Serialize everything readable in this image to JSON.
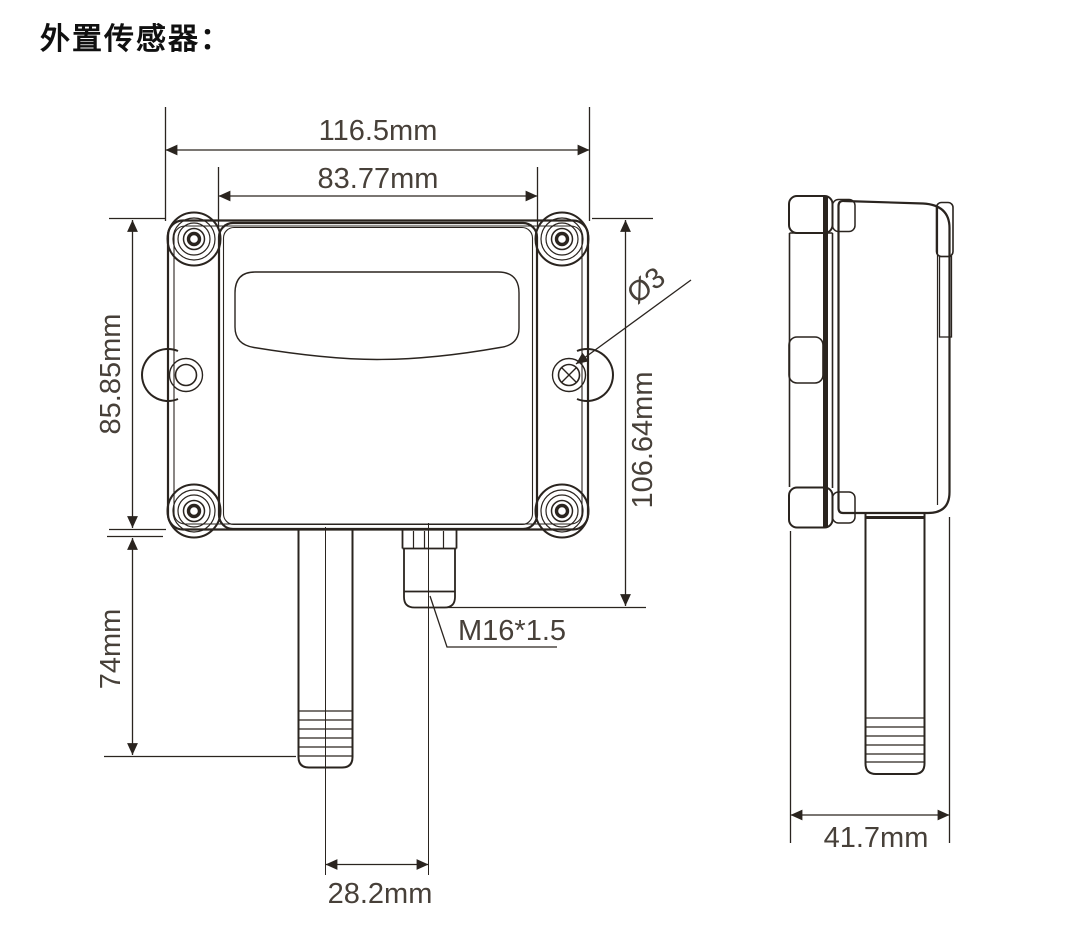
{
  "page": {
    "title": "外置传感器：",
    "background": "#ffffff"
  },
  "diagram": {
    "kind": "technical-dimension-drawing",
    "subject": "external-sensor-enclosure",
    "line_color": "#2a241f",
    "dim_text_color": "#474039",
    "front_view": {
      "outer_width": "116.5mm",
      "lid_width": "83.77mm",
      "body_height": "85.85mm",
      "probe_length": "74mm",
      "overall_height": "106.64mm",
      "mount_hole_diameter": "Ø3",
      "cable_gland_thread": "M16*1.5",
      "probe_center_offset": "28.2mm"
    },
    "side_view": {
      "depth": "41.7mm"
    }
  }
}
